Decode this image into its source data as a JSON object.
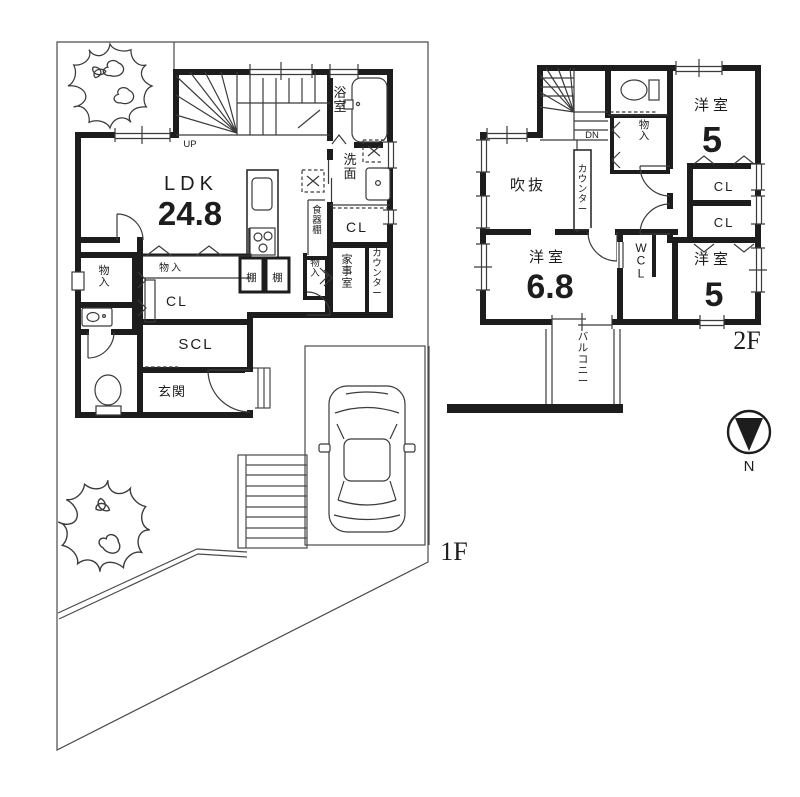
{
  "title": "間取り図",
  "colors": {
    "wall": "#1d1d1d",
    "line": "#3b3b3b",
    "background": "#ffffff"
  },
  "floor1": {
    "floor_label": "1F",
    "stairs_label": "UP",
    "rooms": {
      "ldk": {
        "name": "LDK",
        "area": "24.8"
      },
      "bath": {
        "name": "浴室"
      },
      "washroom": {
        "name": "洗面"
      },
      "dish_shelf": {
        "name": "食器棚"
      },
      "closet_right": {
        "name": "CL"
      },
      "shelf_a": {
        "name": "棚"
      },
      "shelf_b": {
        "name": "棚"
      },
      "storage_hall": {
        "name": "物入"
      },
      "storage_left": {
        "name": "物入"
      },
      "storage_right": {
        "name": "物入"
      },
      "closet_hall": {
        "name": "CL"
      },
      "shoe_closet": {
        "name": "SCL"
      },
      "entrance": {
        "name": "玄関"
      },
      "utility": {
        "name": "家事室"
      },
      "counter": {
        "name": "カウンター"
      }
    }
  },
  "floor2": {
    "floor_label": "2F",
    "stairs_label": "DN",
    "rooms": {
      "void": {
        "name": "吹抜"
      },
      "counter": {
        "name": "カウンター"
      },
      "storage": {
        "name": "物入"
      },
      "west_room_ne": {
        "name": "洋室",
        "area": "5"
      },
      "closet_upper": {
        "name": "CL"
      },
      "closet_lower": {
        "name": "CL"
      },
      "west_room_sw": {
        "name": "洋室",
        "area": "6.8"
      },
      "walk_in_closet": {
        "name": "WCL"
      },
      "west_room_se": {
        "name": "洋室",
        "area": "5"
      },
      "balcony": {
        "name": "バルコニー"
      }
    }
  },
  "compass": {
    "north_label": "N"
  }
}
